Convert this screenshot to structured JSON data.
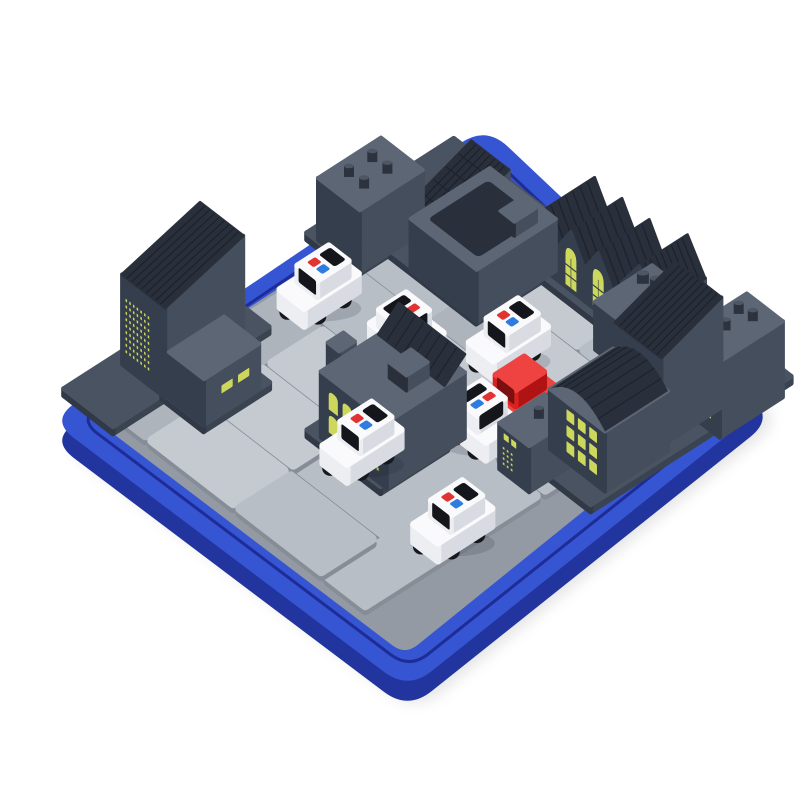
{
  "alt": "Product photo of an isometric city traffic puzzle board game: a square royal-blue tray holding light-gray road tiles, dark slate buildings with lit yellow windows around the edges, six white toy police cars with red and blue roof lights, and one red getaway car",
  "piece_counts": {
    "police_cars": 6,
    "red_cars": 1,
    "buildings": 17,
    "road_tiles": 18
  },
  "board": {
    "rows": 6,
    "cols": 6
  },
  "palette": {
    "bg": "#ffffff",
    "rim_top": "#3655d3",
    "rim_side": "#22349e",
    "rim_groove": "#1d2c96",
    "floor": "#939aa3",
    "tile_a": "#b8bec6",
    "tile_b": "#c5cad0",
    "tile_c": "#aeb4bc",
    "tile_side": "#868d97",
    "platform_top": "#495361",
    "platform_sw": "#313947",
    "platform_se": "#3a4350",
    "bld_sw": "#353e4c",
    "bld_se": "#444e5d",
    "bld_top": "#5d6675",
    "roof": "#2a303b",
    "stripe": "#1d232d",
    "stud_side": "#2c333f",
    "stud_top": "#4d5665",
    "window": "#ccd75c",
    "pane": "#39414e",
    "car_sw": "#eceef2",
    "car_se": "#d8dbe2",
    "car_top": "#fafafc",
    "windshield": "#14161b",
    "wheel": "#17181d",
    "hub": "#ccd0d7",
    "light_red": "#e23333",
    "light_blue": "#2f7ce0",
    "red_sw": "#da2120",
    "red_se": "#b01313",
    "red_top": "#ee4340",
    "red_glass": "#7c1010",
    "shadow": "rgba(20,25,40,0.15)",
    "tray_shadow": "rgba(0,0,0,0.10)"
  },
  "scene": {
    "projection": {
      "origin": [
        460,
        180
      ],
      "u": [
        44,
        34
      ],
      "v": [
        -60,
        38.5
      ]
    },
    "rim_corners": [
      [
        486,
        126
      ],
      [
        774,
        398
      ],
      [
        408,
        690
      ],
      [
        50,
        420
      ]
    ],
    "floor_corners": [
      [
        462,
        170
      ],
      [
        740,
        385
      ],
      [
        405,
        655
      ],
      [
        86,
        413
      ]
    ],
    "tiles": [
      {
        "u": 0,
        "v": 0,
        "w": 2,
        "h": 2
      },
      {
        "u": 2,
        "v": 0,
        "w": 2,
        "h": 1
      },
      {
        "u": 4,
        "v": 0,
        "w": 2,
        "h": 1
      },
      {
        "u": 2,
        "v": 1,
        "w": 1,
        "h": 1
      },
      {
        "u": 3,
        "v": 1,
        "w": 2,
        "h": 1
      },
      {
        "u": 5,
        "v": 1,
        "w": 1,
        "h": 2
      },
      {
        "u": 0,
        "v": 2,
        "w": 2,
        "h": 1
      },
      {
        "u": 2,
        "v": 2,
        "w": 2,
        "h": 1
      },
      {
        "u": 4,
        "v": 2,
        "w": 1,
        "h": 1
      },
      {
        "u": 0,
        "v": 3,
        "w": 1,
        "h": 2
      },
      {
        "u": 1,
        "v": 3,
        "w": 2,
        "h": 1
      },
      {
        "u": 3,
        "v": 3,
        "w": 2,
        "h": 2
      },
      {
        "u": 5,
        "v": 3,
        "w": 1,
        "h": 1
      },
      {
        "u": 1,
        "v": 4,
        "w": 2,
        "h": 1
      },
      {
        "u": 5,
        "v": 4,
        "w": 1,
        "h": 2
      },
      {
        "u": 0,
        "v": 5,
        "w": 1,
        "h": 1
      },
      {
        "u": 1,
        "v": 5,
        "w": 2,
        "h": 1
      },
      {
        "u": 3,
        "v": 5,
        "w": 2,
        "h": 1
      }
    ],
    "platforms": [
      {
        "u": -0.62,
        "v": 0.55,
        "w": 1.1,
        "h": 1.55
      },
      {
        "u": -0.62,
        "v": -0.35,
        "w": 3.1,
        "h": 1.9
      },
      {
        "u": 2.3,
        "v": -0.62,
        "w": 4.38,
        "h": 1.08
      },
      {
        "u": 4.5,
        "v": 0.42,
        "w": 2.18,
        "h": 2.3
      },
      {
        "u": -0.62,
        "v": 3.55,
        "w": 1.12,
        "h": 2.6
      },
      {
        "u": 0.45,
        "v": 4.2,
        "w": 0.95,
        "h": 1.1
      },
      {
        "u": 2.55,
        "v": 3.3,
        "w": 1.67,
        "h": 1.12
      }
    ],
    "pins": [
      {
        "u": 1.7,
        "v": 1.5
      },
      {
        "u": 4.32,
        "v": 0.52
      },
      {
        "u": 6.25,
        "v": 0.85
      }
    ],
    "buildings": [
      {
        "name": "left-top-tower",
        "u": -0.5,
        "v": 0.95,
        "du": 0.95,
        "dv": 1.05,
        "h": 62,
        "roof": {
          "type": "studs",
          "studs": [
            [
              0.32,
              0.35
            ],
            [
              0.68,
              0.35
            ],
            [
              0.32,
              0.72
            ],
            [
              0.68,
              0.72
            ]
          ],
          "r": 5
        }
      },
      {
        "name": "checker-roof-house",
        "u": 0.42,
        "v": 0.12,
        "du": 0.85,
        "dv": 1.05,
        "h": 34,
        "roof": {
          "type": "slope",
          "rise": 24,
          "stripes": 8,
          "cross": 5
        }
      },
      {
        "name": "big-flat-block",
        "u": 0.95,
        "v": 0.2,
        "du": 1.5,
        "dv": 1.32,
        "h": 52,
        "roof": {
          "type": "flat",
          "inset": true
        },
        "extras": [
          {
            "type": "roofbox",
            "x": 0.68,
            "y": 0.16,
            "w": 0.22,
            "h": 0.28,
            "bh": 14
          }
        ]
      },
      {
        "name": "row-house-1",
        "u": 2.0,
        "v": -0.55,
        "du": 0.62,
        "dv": 0.85,
        "h": 34,
        "roof": {
          "type": "gable",
          "rise": 26,
          "stripes": 7
        },
        "windows": [
          {
            "kind": "arch",
            "x": 0.3,
            "w": 0.4
          }
        ]
      },
      {
        "name": "row-house-2",
        "u": 2.62,
        "v": -0.55,
        "du": 0.62,
        "dv": 0.85,
        "h": 34,
        "roof": {
          "type": "gable",
          "rise": 26,
          "stripes": 7
        },
        "windows": [
          {
            "kind": "arch",
            "x": 0.3,
            "w": 0.4
          }
        ]
      },
      {
        "name": "row-house-3",
        "u": 3.24,
        "v": -0.55,
        "du": 0.62,
        "dv": 0.85,
        "h": 34,
        "roof": {
          "type": "gable",
          "rise": 26,
          "stripes": 7
        },
        "windows": [
          {
            "kind": "arch",
            "x": 0.3,
            "w": 0.4
          }
        ]
      },
      {
        "name": "row-house-4",
        "u": 3.95,
        "v": -0.6,
        "du": 0.8,
        "dv": 0.8,
        "h": 40,
        "roof": {
          "type": "gable",
          "rise": 30,
          "stripes": 9
        }
      },
      {
        "name": "studs-block",
        "u": 4.12,
        "v": -0.18,
        "du": 0.82,
        "dv": 0.95,
        "h": 48,
        "roof": {
          "type": "studs",
          "studs": [
            [
              0.25,
              0.32
            ],
            [
              0.52,
              0.26
            ],
            [
              0.78,
              0.35
            ]
          ],
          "r": 6
        }
      },
      {
        "name": "right-tall-tower",
        "u": 5.3,
        "v": 0.3,
        "du": 1.05,
        "dv": 1.0,
        "h": 88,
        "roof": {
          "type": "slope",
          "rise": 22,
          "stripes": 10
        },
        "windows": [
          {
            "face": "sw",
            "kind": "dots",
            "cols": 4,
            "rows": 4,
            "x": 0.5,
            "y": 0.45,
            "w": 0.42,
            "h": 0.48
          }
        ]
      },
      {
        "name": "right-corner-tower",
        "u": 6.0,
        "v": -0.38,
        "du": 0.82,
        "dv": 1.05,
        "h": 76,
        "roof": {
          "type": "studs",
          "studs": [
            [
              0.3,
              0.3
            ],
            [
              0.62,
              0.26
            ],
            [
              0.46,
              0.6
            ]
          ],
          "r": 5
        },
        "windows": [
          {
            "face": "sw",
            "kind": "dots",
            "cols": 4,
            "rows": 6,
            "x": 0.28,
            "y": 0.3,
            "w": 0.55,
            "h": 0.6
          }
        ]
      },
      {
        "name": "arched-roof-flats",
        "u": 5.25,
        "v": 1.3,
        "du": 1.25,
        "dv": 1.05,
        "h": 60,
        "roof": {
          "type": "barrel",
          "rise": 15,
          "ribs": 8
        },
        "windows": [
          {
            "face": "sw",
            "kind": "squares",
            "cols": 3,
            "rows": 3,
            "x": 0.3,
            "y": 0.12,
            "w": 0.62,
            "h": 0.8
          }
        ]
      },
      {
        "name": "knob-block",
        "u": 5.05,
        "v": 2.3,
        "du": 0.68,
        "dv": 0.75,
        "h": 46,
        "roof": {
          "type": "studs",
          "studs": [
            [
              0.5,
              0.45
            ]
          ],
          "r": 5
        },
        "windows": [
          {
            "face": "sw",
            "kind": "dots",
            "cols": 3,
            "rows": 4,
            "x": 0.12,
            "y": 0.45,
            "w": 0.4,
            "h": 0.45
          },
          {
            "face": "sw",
            "kind": "squares",
            "cols": 2,
            "rows": 1,
            "x": 0.15,
            "y": 0.14,
            "w": 0.5,
            "h": 0.2
          }
        ]
      },
      {
        "name": "left-tall-tower",
        "u": -0.52,
        "v": 3.95,
        "du": 0.98,
        "dv": 1.3,
        "h": 90,
        "roof": {
          "type": "slope",
          "rise": 22,
          "stripes": 9
        },
        "windows": [
          {
            "face": "sw",
            "kind": "dots",
            "cols": 7,
            "rows": 9,
            "x": 0.08,
            "y": 0.24,
            "w": 0.6,
            "h": 0.64
          }
        ]
      },
      {
        "name": "two-window-house",
        "u": 0.5,
        "v": 4.3,
        "du": 0.8,
        "dv": 0.92,
        "h": 46,
        "roof": {
          "type": "flat"
        },
        "windows": [
          {
            "face": "se",
            "kind": "squares",
            "cols": 2,
            "rows": 1,
            "x": 0.18,
            "y": 0.38,
            "w": 0.6,
            "h": 0.26
          }
        ]
      },
      {
        "name": "smokestack",
        "u": 2.6,
        "v": 3.85,
        "du": 0.26,
        "dv": 0.26,
        "h": 84,
        "roof": {
          "type": "flat"
        }
      },
      {
        "name": "smokestack-2",
        "u": 2.88,
        "v": 3.6,
        "du": 0.18,
        "dv": 0.18,
        "h": 68,
        "roof": {
          "type": "flat"
        }
      },
      {
        "name": "warehouse-block",
        "u": 2.7,
        "v": 3.0,
        "du": 1.5,
        "dv": 1.3,
        "h": 66,
        "roof": {
          "type": "flat"
        },
        "extras": [
          {
            "type": "wedge",
            "rise": 18,
            "depth": 0.34,
            "stripes": 8
          },
          {
            "type": "roofbox",
            "x": 0.54,
            "y": 0.3,
            "w": 0.26,
            "h": 0.28,
            "bh": 15
          }
        ],
        "windows": [
          {
            "face": "sw",
            "kind": "arch2",
            "cols": 2,
            "rows": 2,
            "x": 0.12,
            "y": 0.2,
            "w": 0.42,
            "h": 0.7
          },
          {
            "face": "sw",
            "kind": "dots",
            "cols": 4,
            "rows": 3,
            "x": 0.62,
            "y": 0.56,
            "w": 0.3,
            "h": 0.34
          }
        ]
      }
    ],
    "cars": [
      {
        "kind": "police",
        "name": "police-car-1",
        "u": 0.55,
        "v": 2.75,
        "facing": "sw"
      },
      {
        "kind": "police",
        "name": "police-car-2",
        "u": 2.2,
        "v": 2.5,
        "facing": "se"
      },
      {
        "kind": "police",
        "name": "police-car-3",
        "u": 3.35,
        "v": 1.65,
        "facing": "sw"
      },
      {
        "kind": "police",
        "name": "police-car-4",
        "u": 3.5,
        "v": 4.2,
        "facing": "sw"
      },
      {
        "kind": "police",
        "name": "police-car-5",
        "u": 4.4,
        "v": 2.85,
        "facing": "se"
      },
      {
        "kind": "police",
        "name": "police-car-6",
        "u": 5.7,
        "v": 4.3,
        "facing": "sw"
      },
      {
        "kind": "suspect",
        "name": "red-suspect-car",
        "u": 4.35,
        "v": 2.25,
        "facing": "sw"
      }
    ]
  }
}
